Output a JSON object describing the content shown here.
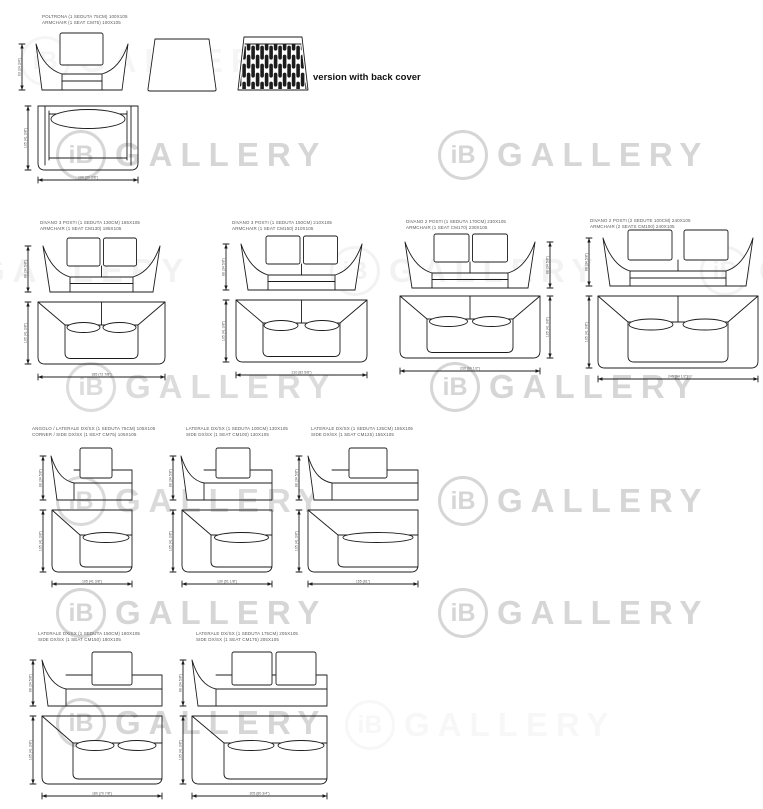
{
  "watermark": {
    "ib": "iB",
    "gallery": "GALLERY"
  },
  "note": "version with back cover",
  "colors": {
    "line": "#1c1c1c",
    "label": "#5a5a5a",
    "watermark": "#d6d6d6",
    "note": "#111111"
  },
  "items": [
    {
      "id": "armchair",
      "line1": "POLTRONA (1 SEDUTA 75CM) 100X105",
      "line2": "ARMCHAIR (1 SEAT CM75) 100X105",
      "dims": {
        "height": "63 (24 3/4\")",
        "depth": "105 (41 3/8\")",
        "width": "100 (39 3/8\")"
      }
    },
    {
      "id": "sofa-185",
      "line1": "DIVANO 3 POSTI (1 SEDUTA 130CM) 185X105",
      "line2": "ARMCHAIR (1 SEAT CM130) 185X105",
      "dims": {
        "height": "88 (34 5/8\")",
        "depth": "105 (41 3/8\")",
        "width": "185 (72 7/8\")"
      }
    },
    {
      "id": "sofa-210",
      "line1": "DIVANO 3 POSTI (1 SEDUTA 150CM) 210X105",
      "line2": "ARMCHAIR (1 SEAT CM150) 210X105",
      "dims": {
        "height": "88 (34 5/8\")",
        "depth": "105 (41 3/8\")",
        "width": "210 (82 5/8\")"
      }
    },
    {
      "id": "sofa-230",
      "line1": "DIVANO 2 POSTI (1 SEDUTA 170CM) 230X105",
      "line2": "ARMCHAIR (1 SEAT CM170) 230X105",
      "dims": {
        "height": "88 (34 5/8\")",
        "depth": "105 (41 3/8\")",
        "width": "230 (90 1/2\")"
      }
    },
    {
      "id": "sofa-240",
      "line1": "DIVANO 2 POSTI (2 SEDUTE 100CM) 240X105",
      "line2": "ARMCHAIR (2 SEATS CM100) 240X105",
      "dims": {
        "height": "88 (34 5/8\")",
        "depth": "105 (41 3/8\")",
        "width": "240 (94 1/2\")"
      }
    },
    {
      "id": "corner-105",
      "line1": "ANGOLO / LATERALE DX/SX (1 SEDUTA 75CM) 105X105",
      "line2": "CORNER / SIDE DX/SX (1 SEAT CM75) 105X105",
      "dims": {
        "height": "88 (34 5/8\")",
        "depth": "105 (41 3/8\")",
        "width": "105 (41 3/8\")"
      }
    },
    {
      "id": "side-130",
      "line1": "LATERALE DX/SX (1 SEDUTA 100CM) 130X105",
      "line2": "SIDE DX/SX (1 SEAT CM100) 130X105",
      "dims": {
        "height": "88 (34 5/8\")",
        "depth": "105 (41 3/8\")",
        "width": "130 (51 1/8\")"
      }
    },
    {
      "id": "side-155",
      "line1": "LATERALE DX/SX (1 SEDUTA 125CM) 155X105",
      "line2": "SIDE DX/SX (1 SEAT CM125) 155X105",
      "dims": {
        "height": "88 (34 5/8\")",
        "depth": "105 (41 3/8\")",
        "width": "155 (61\")"
      }
    },
    {
      "id": "side-180",
      "line1": "LATERALE DX/SX (1 SEDUTA 150CM) 180X105",
      "line2": "SIDE DX/SX (1 SEAT CM150) 180X105",
      "dims": {
        "height": "88 (34 5/8\")",
        "depth": "105 (41 3/8\")",
        "width": "180 (70 7/8\")"
      }
    },
    {
      "id": "side-205",
      "line1": "LATERALE DX/SX (1 SEDUTA 175CM) 205X105",
      "line2": "SIDE DX/SX (1 SEAT CM175) 205X105",
      "dims": {
        "height": "88 (34 5/8\")",
        "depth": "105 (41 3/8\")",
        "width": "205 (80 3/4\")"
      }
    }
  ]
}
